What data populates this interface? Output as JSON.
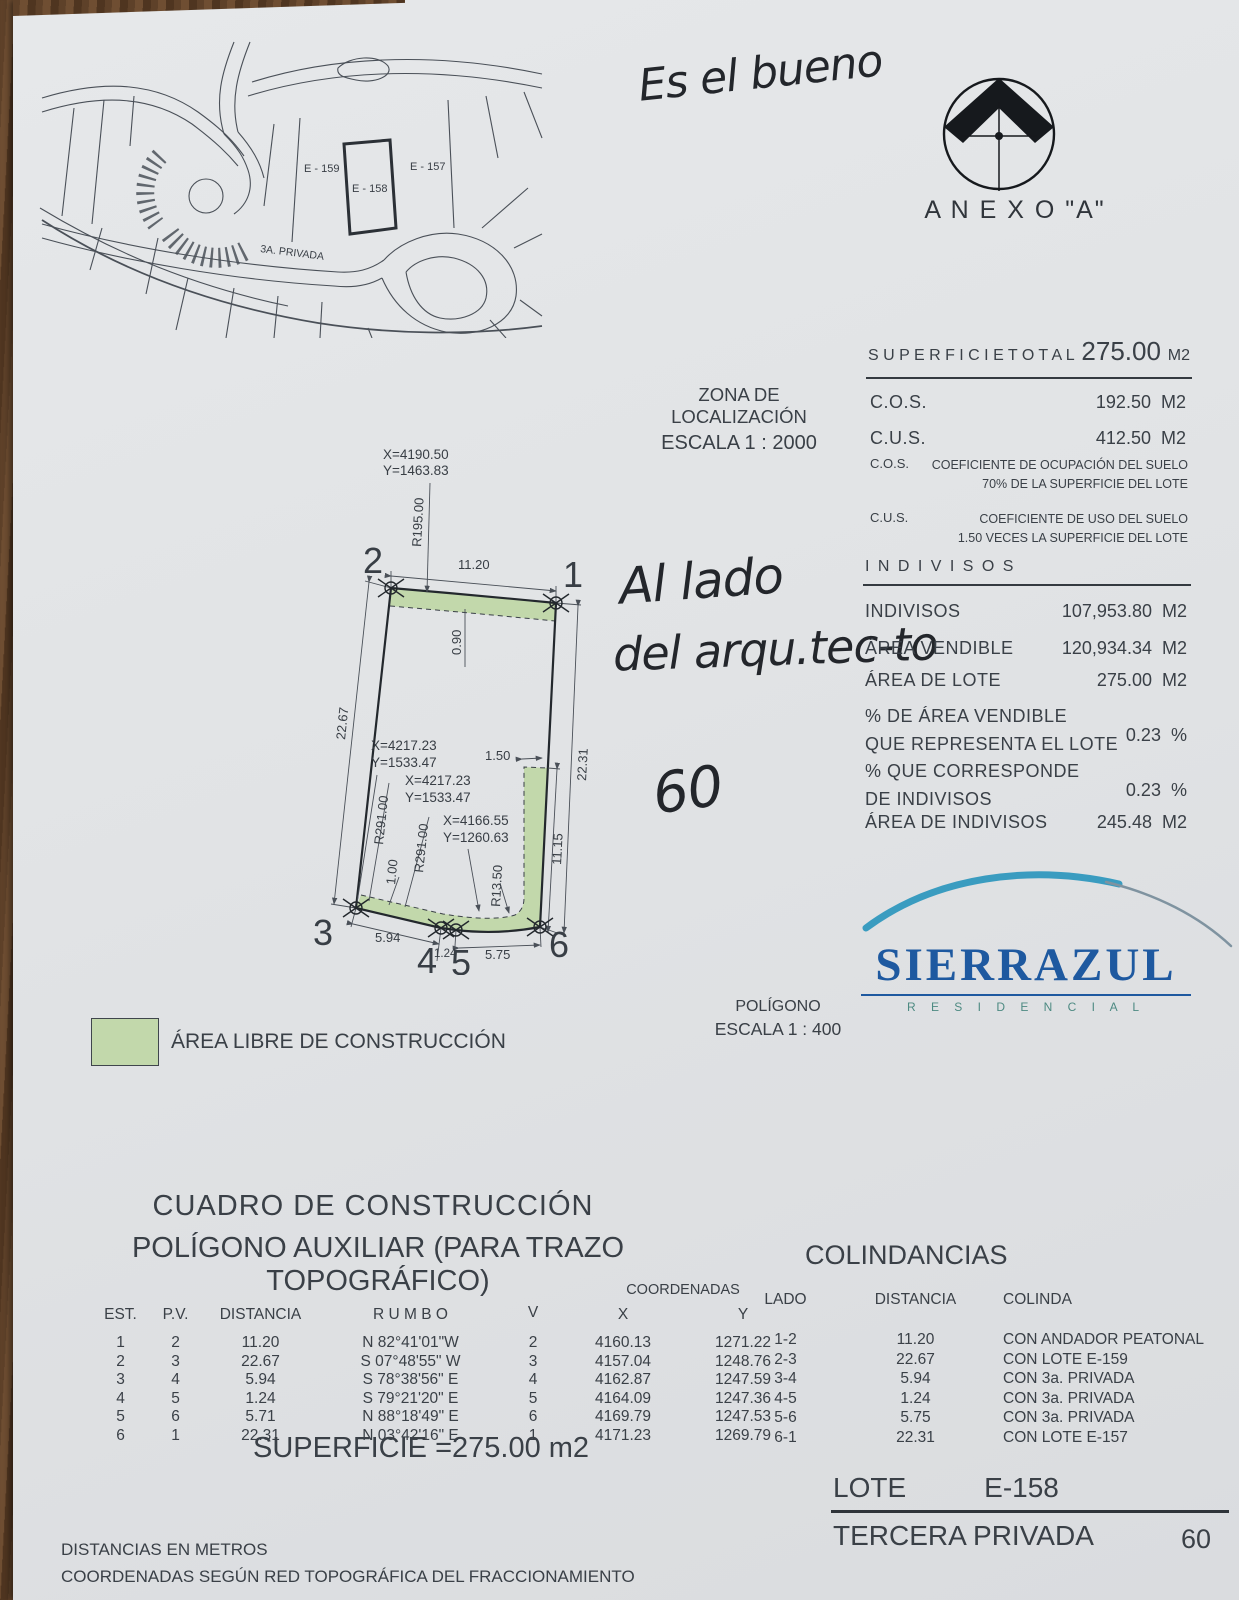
{
  "handwriting": {
    "top_note": "Es el bueno",
    "side_note_line1": "Al lado",
    "side_note_line2": "del arqu.tec-to",
    "number_note": "60"
  },
  "annex": {
    "label": "A N E X O   \"A\""
  },
  "location": {
    "title": "ZONA DE LOCALIZACIÓN",
    "scale": "ESCALA 1 : 2000"
  },
  "map": {
    "lot_left": "E - 159",
    "lot_center": "E - 158",
    "lot_right": "E - 157",
    "street": "3A. PRIVADA"
  },
  "summary": {
    "total_label": "S U P E R F I C I E   T O T A L",
    "total_value": "275.00",
    "total_unit": "M2",
    "cos_label": "C.O.S.",
    "cos_value": "192.50",
    "cos_unit": "M2",
    "cus_label": "C.U.S.",
    "cus_value": "412.50",
    "cus_unit": "M2",
    "cos_note_label": "C.O.S.",
    "cos_note_line1": "COEFICIENTE DE OCUPACIÓN DEL SUELO",
    "cos_note_line2": "70% DE LA SUPERFICIE DEL LOTE",
    "cus_note_label": "C.U.S.",
    "cus_note_line1": "COEFICIENTE DE USO DEL SUELO",
    "cus_note_line2": "1.50 VECES LA SUPERFICIE DEL LOTE"
  },
  "indivisos": {
    "title": "I N D I V I S O S",
    "r1_label": "INDIVISOS",
    "r1_value": "107,953.80",
    "r1_unit": "M2",
    "r2_label": "ÁREA VENDIBLE",
    "r2_value": "120,934.34",
    "r2_unit": "M2",
    "r3_label": "ÁREA DE LOTE",
    "r3_value": "275.00",
    "r3_unit": "M2",
    "r4_label1": "% DE ÁREA VENDIBLE",
    "r4_label2": "QUE REPRESENTA EL LOTE",
    "r4_value": "0.23",
    "r4_unit": "%",
    "r5_label1": "% QUE CORRESPONDE",
    "r5_label2": "DE INDIVISOS",
    "r5_value": "0.23",
    "r5_unit": "%",
    "r6_label": "ÁREA DE INDIVISOS",
    "r6_value": "245.48",
    "r6_unit": "M2"
  },
  "drawing": {
    "coord_top_x": "X=4190.50",
    "coord_top_y": "Y=1463.83",
    "coord_mid1_x": "X=4217.23",
    "coord_mid1_y": "Y=1533.47",
    "coord_mid2_x": "X=4217.23",
    "coord_mid2_y": "Y=1533.47",
    "coord_low_x": "X=4166.55",
    "coord_low_y": "Y=1260.63",
    "dim_top": "11.20",
    "dim_left": "22.67",
    "dim_right": "22.31",
    "dim_right_inner": "11.15",
    "dim_bottom_1": "5.94",
    "dim_bottom_2": "1.24",
    "dim_bottom_3": "5.75",
    "dim_offset_top": "0.90",
    "dim_offset_left": "1.00",
    "dim_strip": "1.50",
    "r_top": "R195.00",
    "r_left_a": "R291.00",
    "r_left_b": "R291.00",
    "r_corner": "R13.50",
    "v1": "1",
    "v2": "2",
    "v3": "3",
    "v4": "4",
    "v5": "5",
    "v6": "6"
  },
  "legend": {
    "label": "ÁREA LIBRE DE CONSTRUCCIÓN",
    "green": "#c2d8ab"
  },
  "poligono": {
    "title": "POLÍGONO",
    "scale": "ESCALA 1 : 400"
  },
  "brand": {
    "name": "SIERRAZUL",
    "tagline": "R E S I D E N C I A L"
  },
  "cuadro": {
    "title1": "CUADRO DE CONSTRUCCIÓN",
    "title2": "POLÍGONO AUXILIAR (PARA TRAZO TOPOGRÁFICO)",
    "h_est": "EST.",
    "h_pv": "P.V.",
    "h_dist": "DISTANCIA",
    "h_rumbo": "R U M B O",
    "h_v": "V",
    "h_coord": "COORDENADAS",
    "h_x": "X",
    "h_y": "Y",
    "rows": [
      {
        "est": "1",
        "pv": "2",
        "dist": "11.20",
        "rumbo": "N 82°41'01\"W",
        "v": "2",
        "x": "4160.13",
        "y": "1271.22"
      },
      {
        "est": "2",
        "pv": "3",
        "dist": "22.67",
        "rumbo": "S 07°48'55\" W",
        "v": "3",
        "x": "4157.04",
        "y": "1248.76"
      },
      {
        "est": "3",
        "pv": "4",
        "dist": "5.94",
        "rumbo": "S 78°38'56\" E",
        "v": "4",
        "x": "4162.87",
        "y": "1247.59"
      },
      {
        "est": "4",
        "pv": "5",
        "dist": "1.24",
        "rumbo": "S 79°21'20\" E",
        "v": "5",
        "x": "4164.09",
        "y": "1247.36"
      },
      {
        "est": "5",
        "pv": "6",
        "dist": "5.71",
        "rumbo": "N 88°18'49\" E",
        "v": "6",
        "x": "4169.79",
        "y": "1247.53"
      },
      {
        "est": "6",
        "pv": "1",
        "dist": "22.31",
        "rumbo": "N 03°42'16\" E",
        "v": "1",
        "x": "4171.23",
        "y": "1269.79"
      }
    ],
    "superficie": "SUPERFICIE =275.00 m2"
  },
  "colindancias": {
    "title": "COLINDANCIAS",
    "h_lado": "LADO",
    "h_dist": "DISTANCIA",
    "h_colinda": "COLINDA",
    "rows": [
      {
        "lado": "1-2",
        "dist": "11.20",
        "colinda": "CON ANDADOR PEATONAL"
      },
      {
        "lado": "2-3",
        "dist": "22.67",
        "colinda": "CON LOTE E-159"
      },
      {
        "lado": "3-4",
        "dist": "5.94",
        "colinda": "CON 3a. PRIVADA"
      },
      {
        "lado": "4-5",
        "dist": "1.24",
        "colinda": "CON 3a. PRIVADA"
      },
      {
        "lado": "5-6",
        "dist": "5.75",
        "colinda": "CON 3a. PRIVADA"
      },
      {
        "lado": "6-1",
        "dist": "22.31",
        "colinda": "CON LOTE E-157"
      }
    ]
  },
  "notes": {
    "line1": "DISTANCIAS EN METROS",
    "line2": "COORDENADAS SEGÚN RED TOPOGRÁFICA DEL FRACCIONAMIENTO"
  },
  "footer": {
    "lote_label": "LOTE",
    "lote_value": "E-158",
    "street": "TERCERA PRIVADA",
    "number": "60"
  }
}
